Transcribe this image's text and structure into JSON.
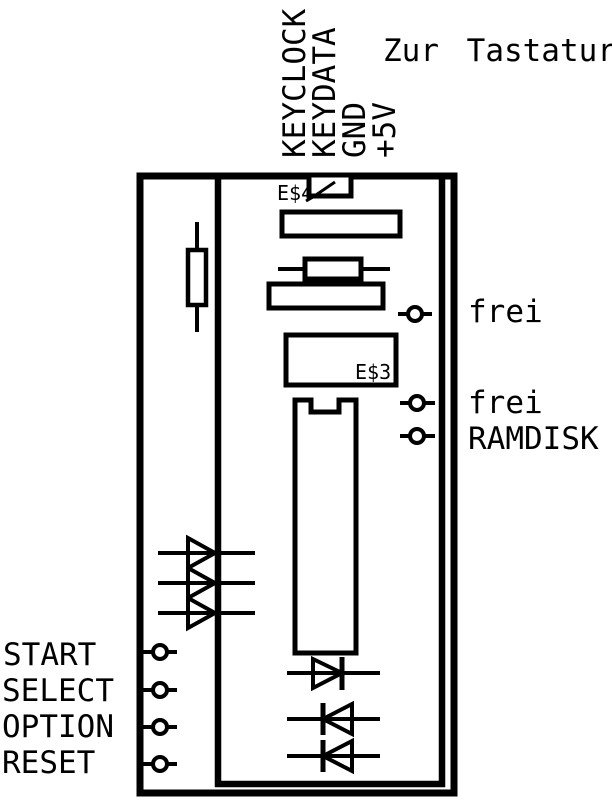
{
  "diagram": {
    "kind": "keyboard-interface-board-schematic",
    "title": "Zur Tastatur",
    "connector": {
      "pins": [
        {
          "label": "KEYCLOCK"
        },
        {
          "label": "KEYDATA"
        },
        {
          "label": "GND"
        },
        {
          "label": "+5V"
        }
      ]
    },
    "chips": {
      "jumper_top": {
        "label": "E$4"
      },
      "rom": {
        "label": "E$3"
      }
    },
    "pads_right": [
      {
        "label": "frei"
      },
      {
        "label": "frei"
      },
      {
        "label": "RAMDISK"
      }
    ],
    "pads_left": [
      {
        "label": "START"
      },
      {
        "label": "SELECT"
      },
      {
        "label": "OPTION"
      },
      {
        "label": "RESET"
      }
    ],
    "colors": {
      "ink": "#000000",
      "paper": "#ffffff"
    }
  }
}
